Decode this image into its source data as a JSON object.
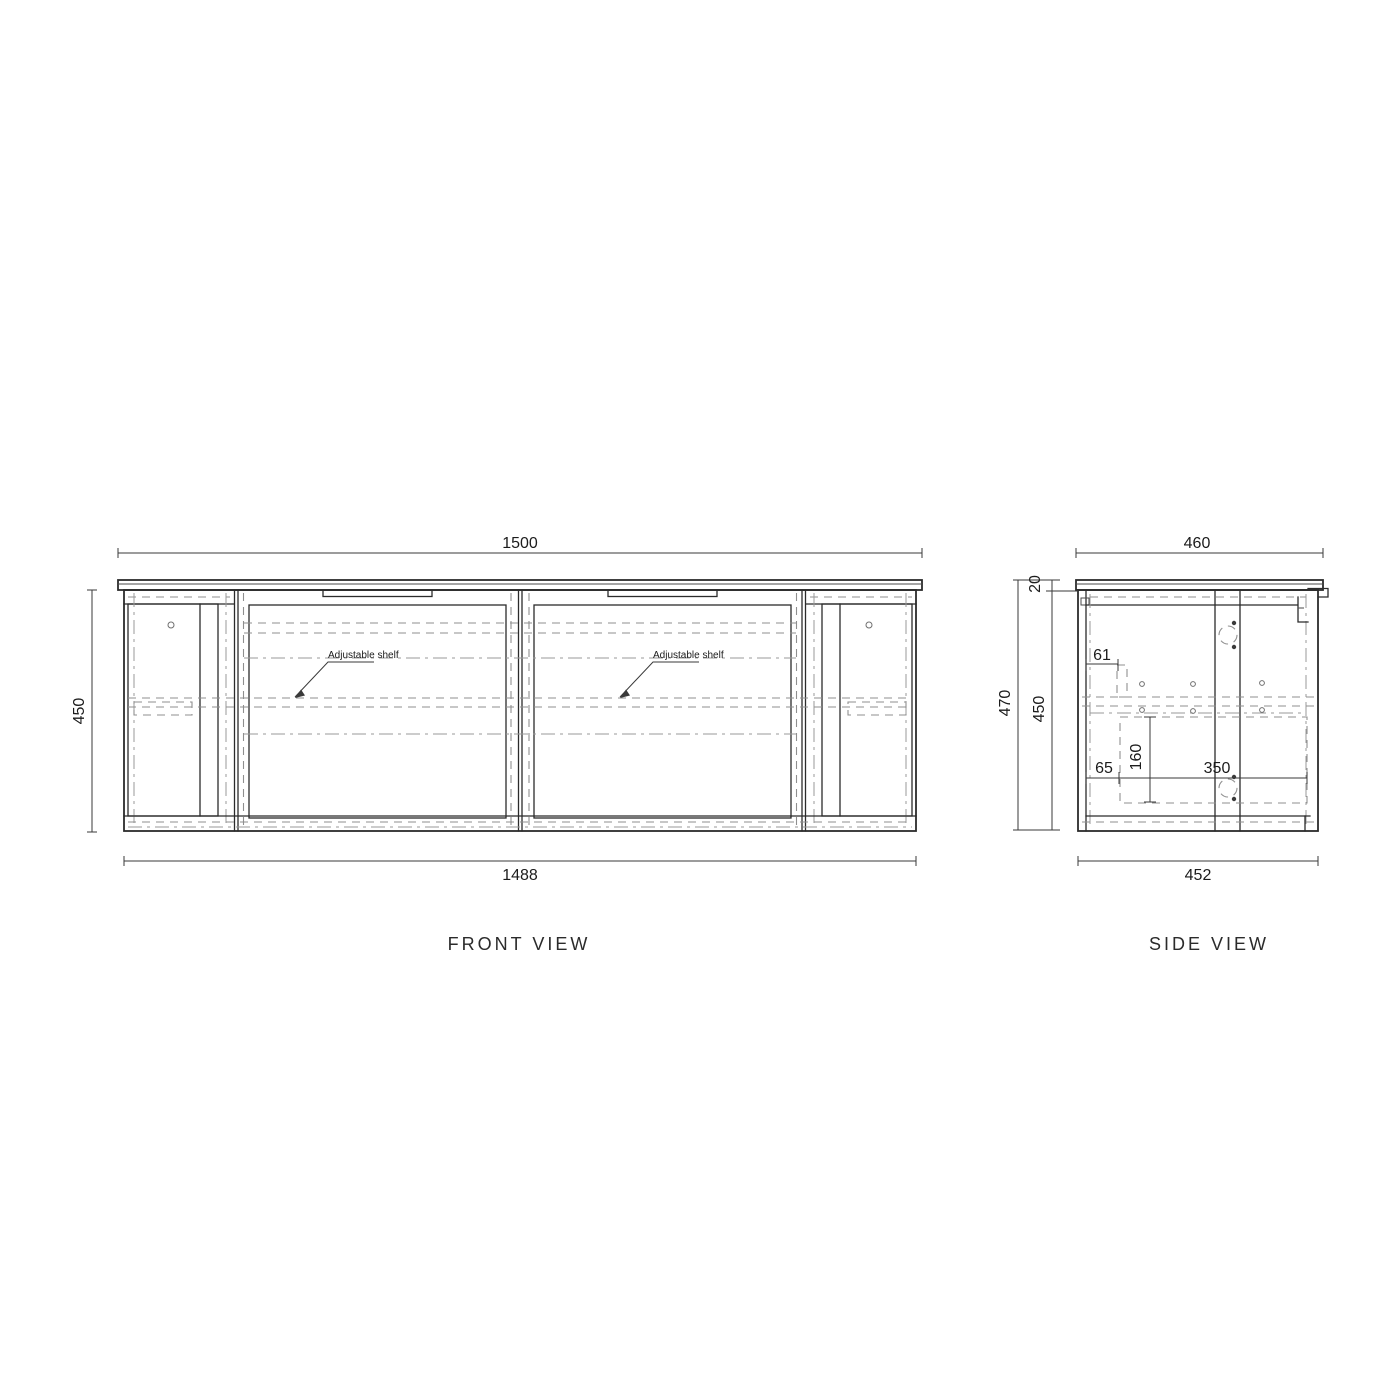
{
  "page": {
    "background": "#ffffff",
    "line_color": "#2b2b2b",
    "hidden_line_color": "#8f8f8f"
  },
  "front_view": {
    "label": "FRONT VIEW",
    "dim_width_top": "1500",
    "dim_width_bottom": "1488",
    "dim_height": "450",
    "shelf_label_left": "Adjustable shelf",
    "shelf_label_right": "Adjustable shelf"
  },
  "side_view": {
    "label": "SIDE VIEW",
    "dim_depth_top": "460",
    "dim_depth_bottom": "452",
    "dim_height_overall": "470",
    "dim_height_carcass": "450",
    "dim_top_thickness": "20",
    "dim_rail_offset": "61",
    "dim_recess_front": "65",
    "dim_recess_height": "160",
    "dim_recess_width": "350"
  }
}
